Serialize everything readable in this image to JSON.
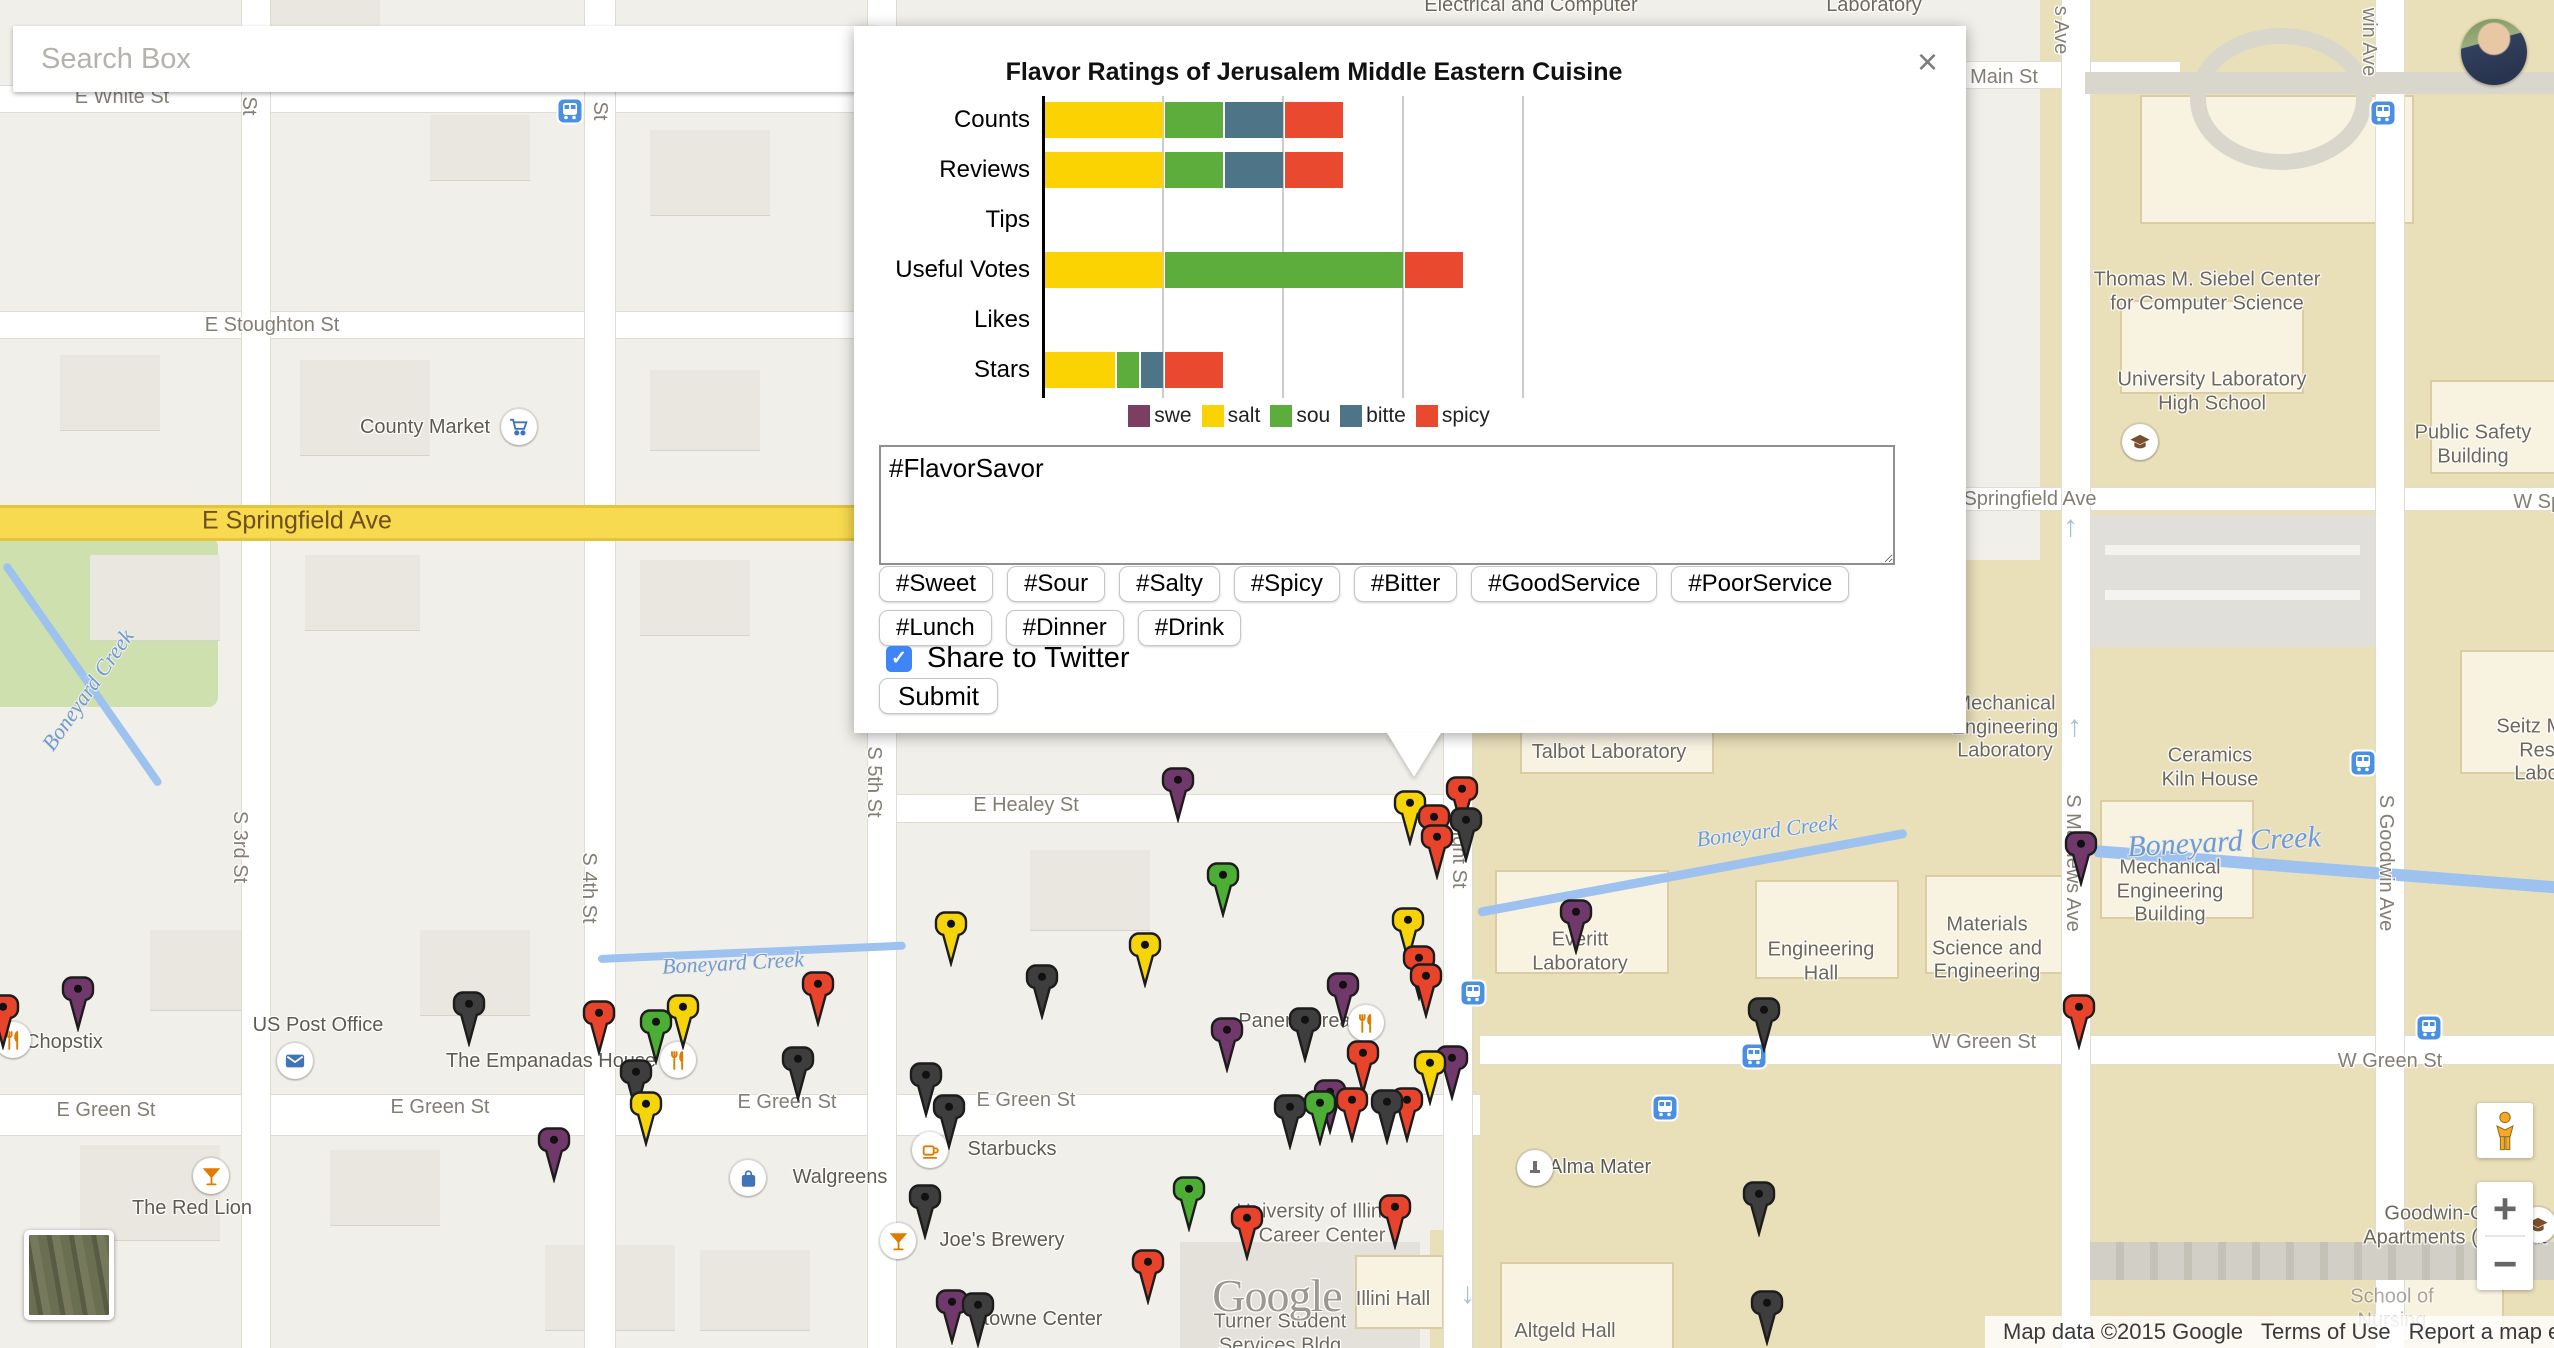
{
  "search": {
    "placeholder": "Search Box"
  },
  "dialog": {
    "close_label": "×",
    "textarea_value": "#FlavorSavor",
    "hashtags_row1": [
      "#Sweet",
      "#Sour",
      "#Salty",
      "#Spicy",
      "#Bitter",
      "#GoodService",
      "#PoorService"
    ],
    "hashtags_row2": [
      "#Lunch",
      "#Dinner",
      "#Drink"
    ],
    "share_label": "Share to Twitter",
    "share_checked": true,
    "submit_label": "Submit",
    "legend": [
      {
        "label": "swe",
        "color": "#7B3F61"
      },
      {
        "label": "salt",
        "color": "#FBD303"
      },
      {
        "label": "sou",
        "color": "#5CAD3C"
      },
      {
        "label": "bitte",
        "color": "#4D7587"
      },
      {
        "label": "spicy",
        "color": "#E8492F"
      }
    ]
  },
  "chart_data": {
    "type": "bar",
    "orientation": "horizontal-stacked",
    "title": "Flavor Ratings of Jerusalem Middle Eastern Cuisine",
    "categories": [
      "Counts",
      "Reviews",
      "Tips",
      "Useful Votes",
      "Likes",
      "Stars"
    ],
    "series": [
      {
        "name": "sweet",
        "color": "#7B3F61",
        "values": [
          0,
          0,
          0,
          0,
          0,
          0
        ]
      },
      {
        "name": "salty",
        "color": "#FBD303",
        "values": [
          1,
          1,
          0,
          1,
          0,
          0.6
        ]
      },
      {
        "name": "sour",
        "color": "#5CAD3C",
        "values": [
          0.5,
          0.5,
          0,
          2,
          0,
          0.2
        ]
      },
      {
        "name": "bitter",
        "color": "#4D7587",
        "values": [
          0.5,
          0.5,
          0,
          0,
          0,
          0.2
        ]
      },
      {
        "name": "spicy",
        "color": "#E8492F",
        "values": [
          0.5,
          0.5,
          0,
          0.5,
          0,
          0.5
        ]
      }
    ],
    "xlim": [
      0,
      4
    ],
    "grid": true,
    "legend_position": "bottom",
    "legend_labels_visible": [
      "swe",
      "salt",
      "sou",
      "bitte",
      "spicy"
    ],
    "unit_px": 120
  },
  "map": {
    "marker_colors": {
      "red": "#E8432B",
      "yellow": "#F6D40A",
      "green": "#4CAE34",
      "purple": "#71396B",
      "black": "#3E3E3E"
    },
    "markers": [
      {
        "x": 3,
        "y": 1007,
        "c": "red"
      },
      {
        "x": 78,
        "y": 989,
        "c": "purple"
      },
      {
        "x": 469,
        "y": 1004,
        "c": "black"
      },
      {
        "x": 599,
        "y": 1013,
        "c": "red"
      },
      {
        "x": 656,
        "y": 1022,
        "c": "green"
      },
      {
        "x": 683,
        "y": 1007,
        "c": "yellow"
      },
      {
        "x": 818,
        "y": 984,
        "c": "red"
      },
      {
        "x": 554,
        "y": 1140,
        "c": "purple"
      },
      {
        "x": 646,
        "y": 1104,
        "c": "yellow"
      },
      {
        "x": 636,
        "y": 1072,
        "c": "black"
      },
      {
        "x": 798,
        "y": 1059,
        "c": "black"
      },
      {
        "x": 951,
        "y": 924,
        "c": "yellow"
      },
      {
        "x": 1042,
        "y": 977,
        "c": "black"
      },
      {
        "x": 1145,
        "y": 945,
        "c": "yellow"
      },
      {
        "x": 1178,
        "y": 780,
        "c": "purple"
      },
      {
        "x": 1223,
        "y": 875,
        "c": "green"
      },
      {
        "x": 926,
        "y": 1075,
        "c": "black"
      },
      {
        "x": 949,
        "y": 1107,
        "c": "black"
      },
      {
        "x": 925,
        "y": 1197,
        "c": "black"
      },
      {
        "x": 952,
        "y": 1302,
        "c": "purple"
      },
      {
        "x": 978,
        "y": 1305,
        "c": "black"
      },
      {
        "x": 1148,
        "y": 1262,
        "c": "red"
      },
      {
        "x": 1247,
        "y": 1218,
        "c": "red"
      },
      {
        "x": 1395,
        "y": 1207,
        "c": "red"
      },
      {
        "x": 1189,
        "y": 1189,
        "c": "green"
      },
      {
        "x": 1343,
        "y": 985,
        "c": "purple"
      },
      {
        "x": 1305,
        "y": 1020,
        "c": "black"
      },
      {
        "x": 1426,
        "y": 976,
        "c": "red"
      },
      {
        "x": 1363,
        "y": 1053,
        "c": "red"
      },
      {
        "x": 1430,
        "y": 1063,
        "c": "yellow"
      },
      {
        "x": 1452,
        "y": 1058,
        "c": "purple"
      },
      {
        "x": 1320,
        "y": 1103,
        "c": "green"
      },
      {
        "x": 1330,
        "y": 1092,
        "c": "purple"
      },
      {
        "x": 1352,
        "y": 1100,
        "c": "red"
      },
      {
        "x": 1387,
        "y": 1102,
        "c": "black"
      },
      {
        "x": 1407,
        "y": 1100,
        "c": "red"
      },
      {
        "x": 1290,
        "y": 1107,
        "c": "black"
      },
      {
        "x": 1227,
        "y": 1030,
        "c": "purple"
      },
      {
        "x": 1410,
        "y": 803,
        "c": "yellow"
      },
      {
        "x": 1462,
        "y": 789,
        "c": "red"
      },
      {
        "x": 1466,
        "y": 820,
        "c": "black"
      },
      {
        "x": 1434,
        "y": 817,
        "c": "red"
      },
      {
        "x": 1437,
        "y": 837,
        "c": "red"
      },
      {
        "x": 1408,
        "y": 920,
        "c": "yellow"
      },
      {
        "x": 1419,
        "y": 958,
        "c": "red"
      },
      {
        "x": 1576,
        "y": 912,
        "c": "purple"
      },
      {
        "x": 1764,
        "y": 1010,
        "c": "black"
      },
      {
        "x": 1759,
        "y": 1194,
        "c": "black"
      },
      {
        "x": 2079,
        "y": 1007,
        "c": "red"
      },
      {
        "x": 2081,
        "y": 844,
        "c": "purple"
      },
      {
        "x": 1767,
        "y": 1303,
        "c": "black"
      }
    ],
    "labels": [
      {
        "text": "E White St",
        "x": 122,
        "y": 98,
        "cls": "st"
      },
      {
        "text": "St",
        "x": 248,
        "y": 106,
        "cls": "st",
        "rot": 90
      },
      {
        "text": "St",
        "x": 599,
        "y": 111,
        "cls": "st",
        "rot": 90
      },
      {
        "text": "E Stoughton St",
        "x": 272,
        "y": 326,
        "cls": "st"
      },
      {
        "text": "E Springfield Ave",
        "x": 297,
        "y": 521,
        "cls": "ave"
      },
      {
        "text": "Springfield Ave",
        "x": 2030,
        "y": 500,
        "cls": "st"
      },
      {
        "text": "W Springfield Ave",
        "x": 2592,
        "y": 503,
        "cls": "st"
      },
      {
        "text": "E Healey St",
        "x": 1026,
        "y": 806,
        "cls": "st"
      },
      {
        "text": "E Green St",
        "x": 106,
        "y": 1111,
        "cls": "st"
      },
      {
        "text": "E Green St",
        "x": 440,
        "y": 1108,
        "cls": "st"
      },
      {
        "text": "E Green St",
        "x": 787,
        "y": 1103,
        "cls": "st"
      },
      {
        "text": "E Green St",
        "x": 1026,
        "y": 1101,
        "cls": "st"
      },
      {
        "text": "W Green St",
        "x": 1984,
        "y": 1043,
        "cls": "st"
      },
      {
        "text": "W Green St",
        "x": 2390,
        "y": 1062,
        "cls": "st"
      },
      {
        "text": "Main St",
        "x": 2004,
        "y": 78,
        "cls": "st"
      },
      {
        "text": "S 3rd St",
        "x": 239,
        "y": 847,
        "cls": "st",
        "rot": 90
      },
      {
        "text": "S 4th St",
        "x": 588,
        "y": 888,
        "cls": "st",
        "rot": 90
      },
      {
        "text": "S 5th St",
        "x": 873,
        "y": 782,
        "cls": "st",
        "rot": 90
      },
      {
        "text": "S Wright St",
        "x": 1458,
        "y": 838,
        "cls": "st",
        "rot": 90
      },
      {
        "text": "S Mathews Ave",
        "x": 2072,
        "y": 863,
        "cls": "st",
        "rot": 90
      },
      {
        "text": "S Goodwin Ave",
        "x": 2385,
        "y": 863,
        "cls": "st",
        "rot": 90
      },
      {
        "text": "s Ave",
        "x": 2060,
        "y": 30,
        "cls": "st",
        "rot": 90
      },
      {
        "text": "win Ave",
        "x": 2368,
        "y": 42,
        "cls": "st",
        "rot": 90
      },
      {
        "text": "Chopstix",
        "x": 64,
        "y": 1043,
        "cls": "poi"
      },
      {
        "text": "County Market",
        "x": 425,
        "y": 428,
        "cls": "poi"
      },
      {
        "text": "US Post Office",
        "x": 318,
        "y": 1026,
        "cls": "poi"
      },
      {
        "text": "The Empanadas House",
        "x": 551,
        "y": 1062,
        "cls": "poi"
      },
      {
        "text": "The Red Lion",
        "x": 192,
        "y": 1209,
        "cls": "poi"
      },
      {
        "text": "Walgreens",
        "x": 840,
        "y": 1178,
        "cls": "poi"
      },
      {
        "text": "Starbucks",
        "x": 1012,
        "y": 1150,
        "cls": "poi"
      },
      {
        "text": "Joe's Brewery",
        "x": 1002,
        "y": 1241,
        "cls": "poi"
      },
      {
        "text": "Panera Bread",
        "x": 1300,
        "y": 1022,
        "cls": "poi"
      },
      {
        "text": "towne Center",
        "x": 1043,
        "y": 1320,
        "cls": "poi"
      },
      {
        "text": "Alma Mater",
        "x": 1600,
        "y": 1168,
        "cls": "poi"
      },
      {
        "text": "Talbot Laboratory",
        "x": 1609,
        "y": 753,
        "cls": "bld"
      },
      {
        "text": "Everitt\nLaboratory",
        "x": 1580,
        "y": 952,
        "cls": "bld"
      },
      {
        "text": "Engineering\nHall",
        "x": 1821,
        "y": 962,
        "cls": "bld"
      },
      {
        "text": "Materials\nScience and\nEngineering",
        "x": 1987,
        "y": 949,
        "cls": "bld"
      },
      {
        "text": "Mechanical\nEngineering\nBuilding",
        "x": 2170,
        "y": 892,
        "cls": "bld"
      },
      {
        "text": "Mechanical\nEngineering\nLaboratory",
        "x": 2005,
        "y": 728,
        "cls": "bld"
      },
      {
        "text": "Ceramics\nKiln House",
        "x": 2210,
        "y": 768,
        "cls": "bld"
      },
      {
        "text": "Thomas M. Siebel Center\nfor Computer Science",
        "x": 2207,
        "y": 292,
        "cls": "bld"
      },
      {
        "text": "University Laboratory\nHigh School",
        "x": 2212,
        "y": 392,
        "cls": "bld"
      },
      {
        "text": "Public Safety\nBuilding",
        "x": 2473,
        "y": 445,
        "cls": "bld"
      },
      {
        "text": "Laboratory",
        "x": 1874,
        "y": 6,
        "cls": "bld"
      },
      {
        "text": "Electrical and Computer",
        "x": 1531,
        "y": 6,
        "cls": "bld"
      },
      {
        "text": "Seitz Materials\nResearch\nLaboratory",
        "x": 2562,
        "y": 751,
        "cls": "bld"
      },
      {
        "text": "School of\nNursing",
        "x": 2392,
        "y": 1309,
        "cls": "bld faded"
      },
      {
        "text": "Goodwin-Green\nApartments (Student",
        "x": 2455,
        "y": 1226,
        "cls": "bld"
      },
      {
        "text": "University of Illinois\nCareer Center",
        "x": 1322,
        "y": 1224,
        "cls": "bld"
      },
      {
        "text": "Illini Hall",
        "x": 1393,
        "y": 1300,
        "cls": "bld"
      },
      {
        "text": "Altgeld Hall",
        "x": 1565,
        "y": 1332,
        "cls": "bld"
      },
      {
        "text": "Turner Student\nServices Bldg",
        "x": 1280,
        "y": 1334,
        "cls": "bld"
      },
      {
        "text": "Boneyard Creek",
        "x": 88,
        "y": 690,
        "cls": "wtr",
        "rot": -55
      },
      {
        "text": "Boneyard Creek",
        "x": 733,
        "y": 963,
        "cls": "wtr",
        "rot": -3
      },
      {
        "text": "Boneyard Creek",
        "x": 1767,
        "y": 831,
        "cls": "wtr",
        "rot": -7
      },
      {
        "text": "Boneyard Creek",
        "x": 2224,
        "y": 842,
        "cls": "wtr",
        "rot": -3,
        "fs": 30
      },
      {
        "text": "Google",
        "x": 1277,
        "y": 1296,
        "cls": "glogo"
      }
    ],
    "pois": [
      {
        "x": 13,
        "y": 1040,
        "type": "restaurant"
      },
      {
        "x": 519,
        "y": 427,
        "type": "cart"
      },
      {
        "x": 295,
        "y": 1061,
        "type": "mail"
      },
      {
        "x": 678,
        "y": 1060,
        "type": "restaurant"
      },
      {
        "x": 211,
        "y": 1176,
        "type": "cocktail"
      },
      {
        "x": 748,
        "y": 1178,
        "type": "bag"
      },
      {
        "x": 930,
        "y": 1150,
        "type": "coffee"
      },
      {
        "x": 898,
        "y": 1241,
        "type": "cocktail"
      },
      {
        "x": 1366,
        "y": 1023,
        "type": "restaurant"
      },
      {
        "x": 1535,
        "y": 1168,
        "type": "monument"
      },
      {
        "x": 2140,
        "y": 442,
        "type": "gradcap"
      },
      {
        "x": 2538,
        "y": 1225,
        "type": "gradcap"
      }
    ],
    "bus_stops": [
      {
        "x": 570,
        "y": 111
      },
      {
        "x": 2383,
        "y": 113
      },
      {
        "x": 2363,
        "y": 763
      },
      {
        "x": 1473,
        "y": 993
      },
      {
        "x": 1754,
        "y": 1056
      },
      {
        "x": 1665,
        "y": 1108
      },
      {
        "x": 2429,
        "y": 1028
      }
    ],
    "oneway_arrows": [
      {
        "x": 2073,
        "y": 530,
        "d": "↑"
      },
      {
        "x": 2077,
        "y": 730,
        "d": "↑"
      },
      {
        "x": 1470,
        "y": 1297,
        "d": "↓"
      }
    ],
    "attribution": {
      "map_data": "Map data ©2015 Google",
      "terms": "Terms of Use",
      "report": "Report a map error"
    },
    "controls": {
      "zoom_in": "+",
      "zoom_out": "−"
    }
  }
}
